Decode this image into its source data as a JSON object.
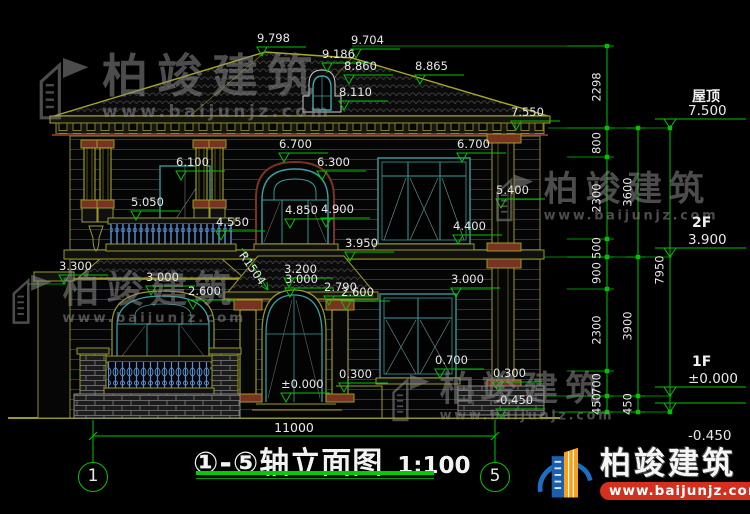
{
  "title": {
    "axis_range": "①-⑤",
    "name": "轴立面图",
    "scale": "1:100"
  },
  "axis_bubbles": [
    {
      "label": "1",
      "x": 93
    },
    {
      "label": "5",
      "x": 495
    }
  ],
  "bottom": {
    "width_dim": "11000"
  },
  "radius_dim": "R1504",
  "annotations": [
    [
      "9.798",
      262,
      56
    ],
    [
      "9.704",
      356,
      58
    ],
    [
      "9.186",
      327,
      72
    ],
    [
      "8.860",
      349,
      84
    ],
    [
      "8.865",
      420,
      84
    ],
    [
      "8.110",
      344,
      110
    ],
    [
      "7.550",
      516,
      130
    ],
    [
      "6.700",
      284,
      162
    ],
    [
      "6.700",
      462,
      162
    ],
    [
      "6.100",
      181,
      180
    ],
    [
      "6.300",
      322,
      180
    ],
    [
      "5.400",
      501,
      208
    ],
    [
      "5.050",
      136,
      220
    ],
    [
      "4.850",
      290,
      228
    ],
    [
      "4.900",
      326,
      227
    ],
    [
      "4.550",
      221,
      240
    ],
    [
      "4.400",
      458,
      244
    ],
    [
      "3.950",
      350,
      261
    ],
    [
      "3.300",
      64,
      284
    ],
    [
      "3.200",
      289,
      287
    ],
    [
      "3.000",
      290,
      297
    ],
    [
      "3.000",
      151,
      295
    ],
    [
      "2.600",
      193,
      309
    ],
    [
      "2.790",
      329,
      305
    ],
    [
      "2.600",
      346,
      310
    ],
    [
      "3.000",
      456,
      297
    ],
    [
      "0.700",
      440,
      378
    ],
    [
      "0.300",
      344,
      392
    ],
    [
      "±0.000",
      286,
      402
    ],
    [
      "0.300",
      498,
      391
    ],
    [
      "-0.450",
      501,
      418
    ]
  ],
  "right_panel": {
    "levels": [
      {
        "name": "屋顶",
        "elev": "7.500",
        "y": 128,
        "below": false
      },
      {
        "name": "2F",
        "elev": "3.900",
        "y": 257,
        "below": false
      },
      {
        "name": "1F",
        "elev": "±0.000",
        "y": 396,
        "below": false
      },
      {
        "name": "",
        "elev": "-0.450",
        "y": 412,
        "below": true
      }
    ],
    "chains": [
      {
        "x": 607,
        "stub": 40,
        "ticks": [
          46,
          128,
          157,
          239,
          257,
          289,
          371,
          396,
          412
        ],
        "segs": [
          [
            "2298",
            87
          ],
          [
            "800",
            143
          ],
          [
            "2300",
            198
          ],
          [
            "500",
            248
          ],
          [
            "900",
            273
          ],
          [
            "2300",
            330
          ],
          [
            "700",
            384
          ],
          [
            "450",
            404
          ]
        ]
      },
      {
        "x": 638,
        "stub": 12,
        "ticks": [
          128,
          257,
          396,
          412
        ],
        "segs": [
          [
            "3600",
            192
          ],
          [
            "3900",
            326
          ],
          [
            "450",
            404
          ]
        ]
      },
      {
        "x": 670,
        "stub": 0,
        "ticks": [
          128,
          412
        ],
        "segs": [
          [
            "7950",
            270
          ]
        ]
      }
    ]
  },
  "watermark": {
    "name": "柏竣建筑",
    "url": "www.baijunjz.com",
    "instances": [
      {
        "x": 34,
        "y": 52,
        "s": 1
      },
      {
        "x": 8,
        "y": 270,
        "s": 0.8
      },
      {
        "x": 492,
        "y": 170,
        "s": 0.76
      },
      {
        "x": 388,
        "y": 370,
        "s": 0.76
      }
    ]
  },
  "logo": {
    "name": "柏竣建筑",
    "url": "www.baijunjz.com"
  },
  "colors": {
    "dim_green": "#00c400",
    "cad_yellow": "#9a9a24",
    "window_teal": "#37a0a0",
    "text_white": "#e8e8e8",
    "logo_blue": "#1a6fc4",
    "logo_orange": "#f5a01e",
    "logo_red": "#d33020"
  }
}
